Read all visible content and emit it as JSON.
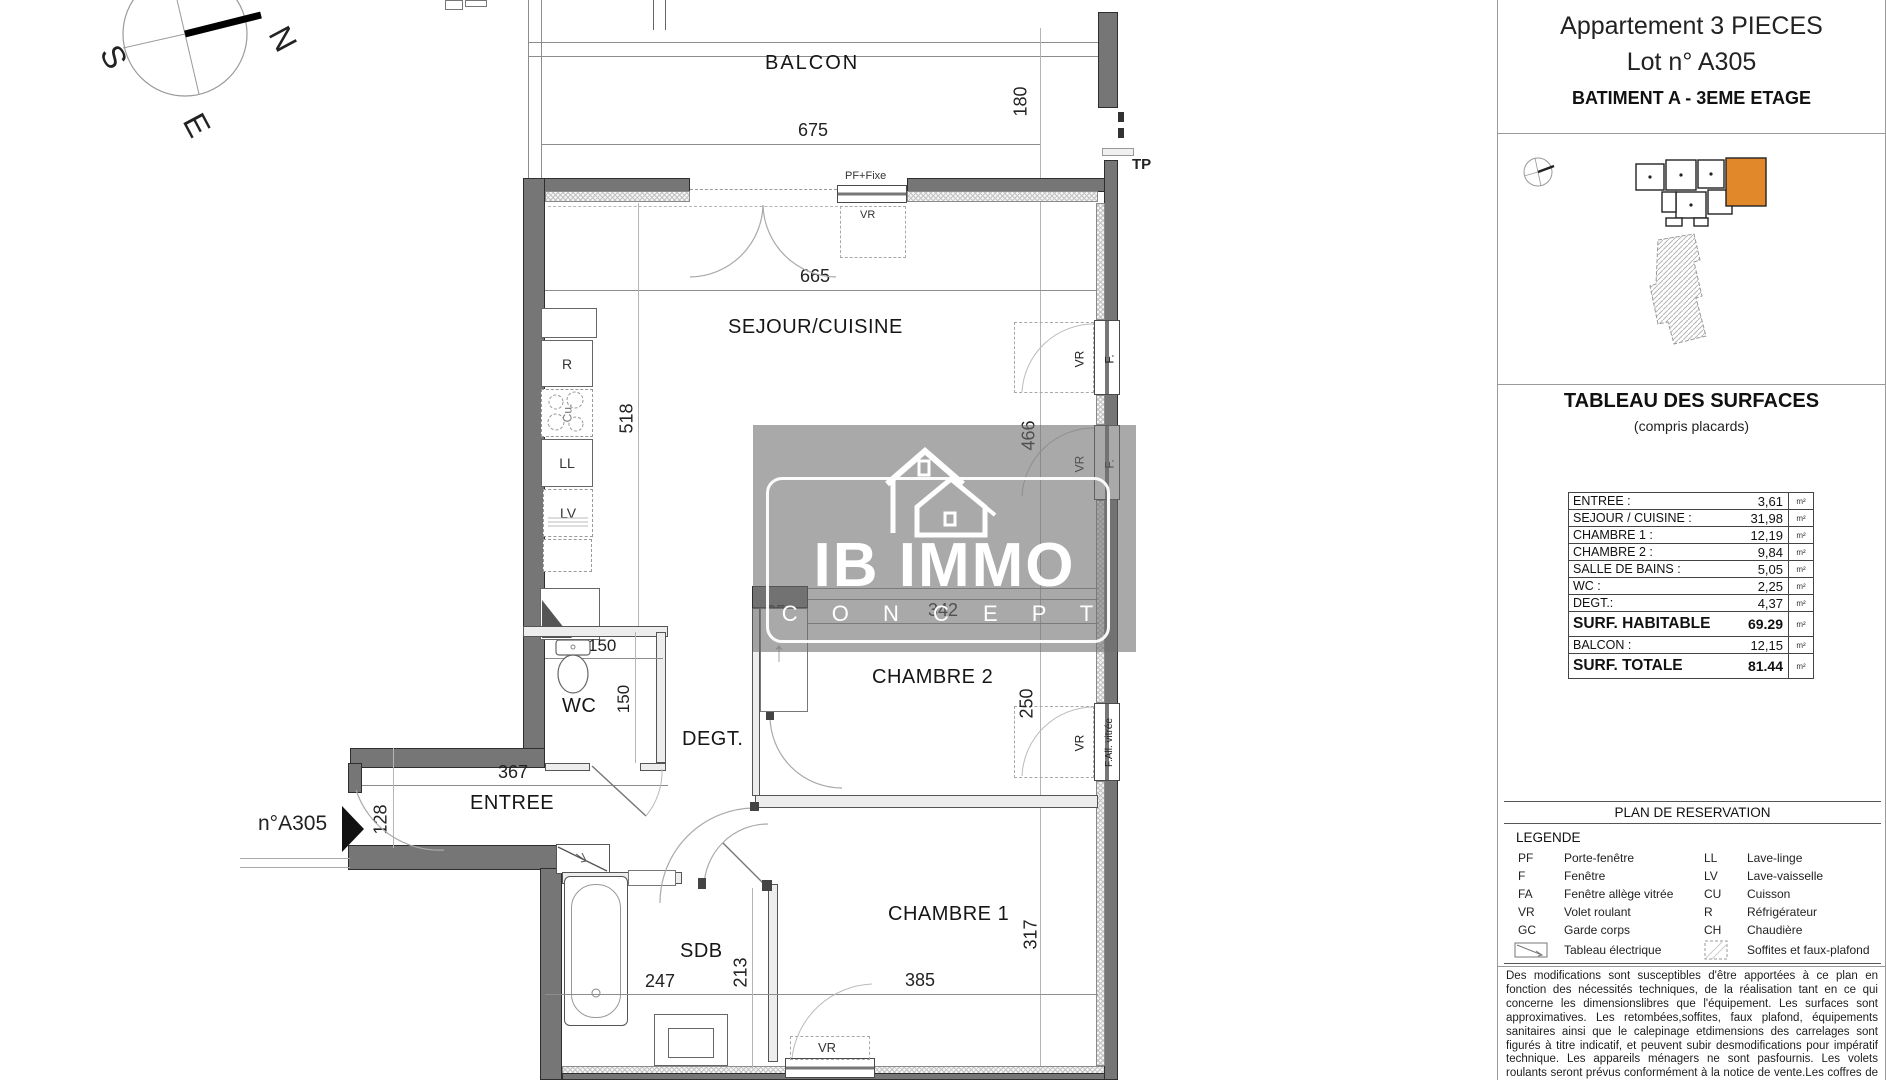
{
  "title_block": {
    "line1": "Appartement 3 PIECES",
    "line2": "Lot n° A305",
    "line3": "BATIMENT A - 3EME ETAGE"
  },
  "key_plan": {
    "highlight_color": "#e0882a"
  },
  "surfaces": {
    "title": "TABLEAU DES SURFACES",
    "subtitle": "(compris placards)",
    "unit": "m²",
    "rows": [
      {
        "label": "ENTREE :",
        "value": "3,61"
      },
      {
        "label": "SEJOUR / CUISINE :",
        "value": "31,98"
      },
      {
        "label": "CHAMBRE 1 :",
        "value": "12,19"
      },
      {
        "label": "CHAMBRE 2 :",
        "value": "9,84"
      },
      {
        "label": "SALLE DE BAINS :",
        "value": "5,05"
      },
      {
        "label": "WC :",
        "value": "2,25"
      },
      {
        "label": "DEGT.:",
        "value": "4,37"
      },
      {
        "label": "SURF. HABITABLE",
        "value": "69.29"
      },
      {
        "label": "BALCON :",
        "value": "12,15"
      },
      {
        "label": "SURF. TOTALE",
        "value": "81.44"
      }
    ]
  },
  "reservation": {
    "header": "PLAN DE RESERVATION",
    "legend_title": "LEGENDE",
    "left": [
      {
        "abbr": "PF",
        "label": "Porte-fenêtre"
      },
      {
        "abbr": "F",
        "label": "Fenêtre"
      },
      {
        "abbr": "FA",
        "label": "Fenêtre allège vitrée"
      },
      {
        "abbr": "VR",
        "label": "Volet roulant"
      },
      {
        "abbr": "GC",
        "label": "Garde corps"
      }
    ],
    "right": [
      {
        "abbr": "LL",
        "label": "Lave-linge"
      },
      {
        "abbr": "LV",
        "label": "Lave-vaisselle"
      },
      {
        "abbr": "CU",
        "label": "Cuisson"
      },
      {
        "abbr": "R",
        "label": "Réfrigérateur"
      },
      {
        "abbr": "CH",
        "label": "Chaudière"
      }
    ],
    "symbols": [
      {
        "label": "Tableau électrique"
      },
      {
        "label": "Soffites et faux-plafond"
      }
    ]
  },
  "disclaimer": "Des modifications sont susceptibles d'être apportées à ce plan en fonction des nécessités techniques, de la réalisation tant en ce qui concerne les dimensionslibres que l'équipement. Les surfaces sont approximatives. Les retombées,soffites, faux plafond, équipements sanitaires ainsi que le calepinage etdimensions des carrelages sont figurés à titre indicatif, et peuvent subir desmodifications pour impératif technique. Les appareils ménagers ne sont pasfournis.  Les volets roulants seront prévus conformément à la notice de vente.Les coffres de volet roulant ne sont pas représentés et seront débordants à l'intérieur. La hauteur des seuils au droit des porte-fenêtres ou baies",
  "compass": {
    "n": "N",
    "s": "S",
    "e": "E"
  },
  "watermark": {
    "line1": "IB IMMO",
    "line2": "C O N C E P T"
  },
  "plan": {
    "rooms": {
      "balcon": "BALCON",
      "sejour": "SEJOUR/CUISINE",
      "chambre2": "CHAMBRE 2",
      "chambre1": "CHAMBRE 1",
      "wc": "WC",
      "degt": "DEGT.",
      "entree": "ENTREE",
      "sdb": "SDB"
    },
    "dims": {
      "d675": "675",
      "d180": "180",
      "d665": "665",
      "d518": "518",
      "d466": "466",
      "d65": "65",
      "d342": "342",
      "d150w": "150",
      "d150d": "150",
      "d367": "367",
      "d128": "128",
      "d250": "250",
      "d317": "317",
      "d385": "385",
      "d247": "247",
      "d213": "213"
    },
    "tags": {
      "lot": "n°A305",
      "tp": "TP",
      "pf_fixe": "PF+Fixe",
      "vr": "VR",
      "f": "F.",
      "fa": "F.All. vitrée"
    },
    "appliances": {
      "r": "R",
      "cu": "Cu.",
      "ll": "LL",
      "lv": "LV"
    }
  }
}
